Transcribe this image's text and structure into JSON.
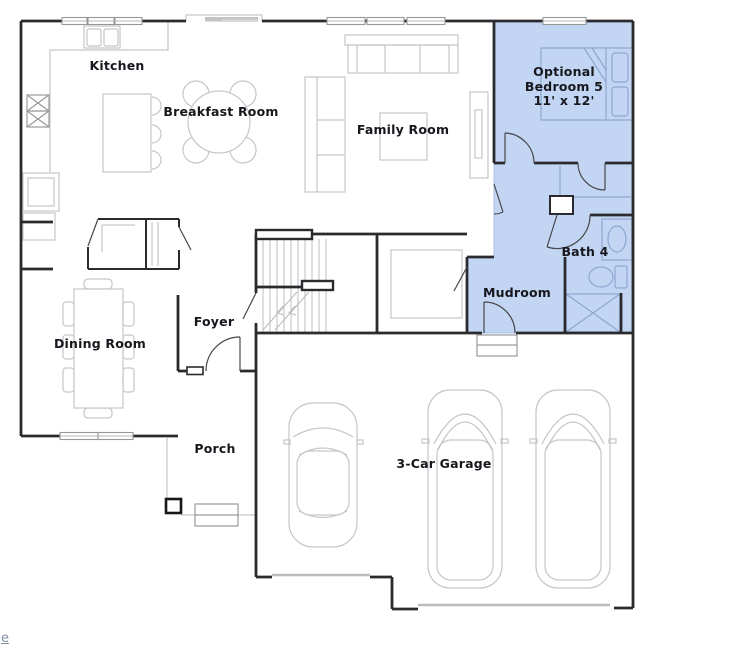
{
  "colors": {
    "wall": "#2b2b2f",
    "furniture": "#c6c6c8",
    "highlight_fill": "#c2d6f4",
    "highlight_edge": "#a8c0e8",
    "blue_furniture": "#8fa6cf",
    "label": "#17171d",
    "link": "#8290a6"
  },
  "rooms": {
    "kitchen": {
      "label": "Kitchen"
    },
    "breakfast": {
      "label": "Breakfast Room"
    },
    "family": {
      "label": "Family Room"
    },
    "bedroom5": {
      "label_line1": "Optional",
      "label_line2": "Bedroom 5",
      "dimensions": "11' x 12'"
    },
    "bath4": {
      "label": "Bath 4"
    },
    "mudroom": {
      "label": "Mudroom"
    },
    "foyer": {
      "label": "Foyer"
    },
    "dining": {
      "label": "Dining Room"
    },
    "porch": {
      "label": "Porch"
    },
    "garage": {
      "label": "3-Car Garage"
    }
  },
  "partial_link": {
    "text": "e"
  }
}
